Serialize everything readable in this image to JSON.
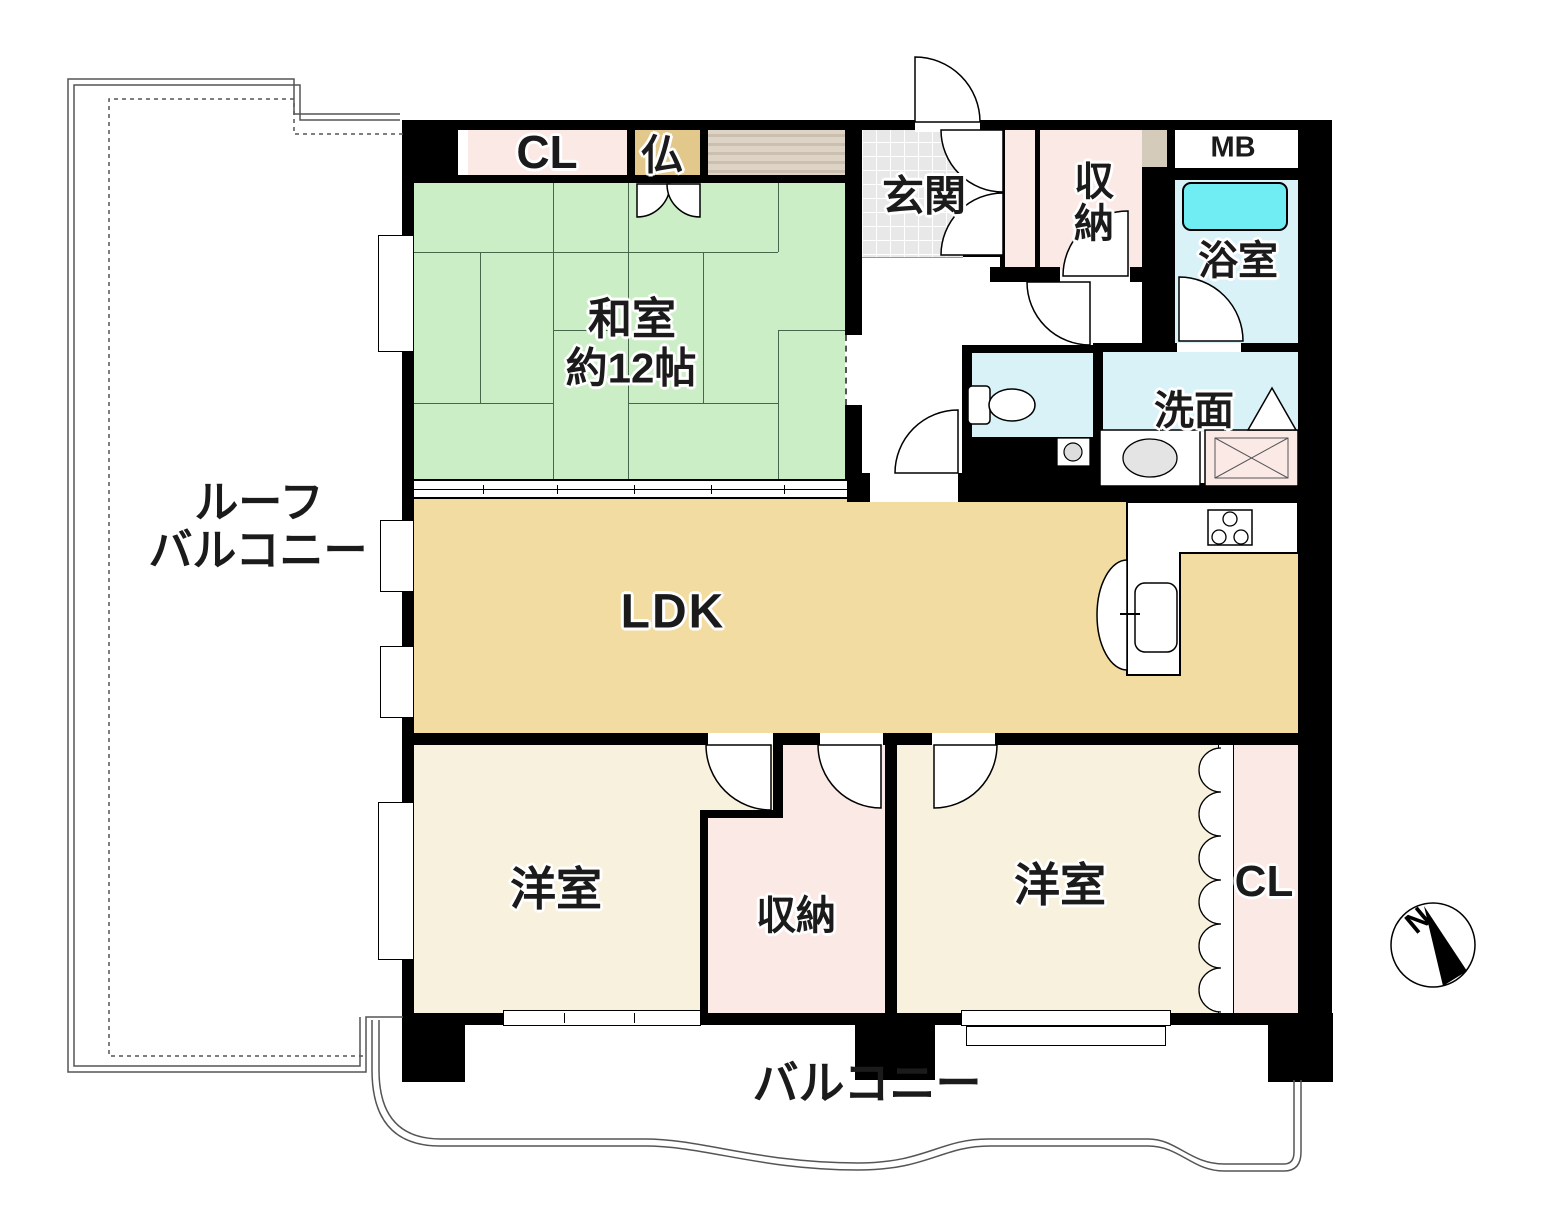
{
  "plan_title": "マンション間取り図",
  "rooms": {
    "roof_balcony": {
      "line1": "ルーフ",
      "line2": "バルコニー"
    },
    "washitsu": {
      "name": "和室",
      "size": "約12帖"
    },
    "closet_top": {
      "label": "CL"
    },
    "butsudan": {
      "label": "仏"
    },
    "genkan": {
      "label": "玄関"
    },
    "storage_top": {
      "label": "収納"
    },
    "meter_box": {
      "label": "MB"
    },
    "bathroom": {
      "label": "浴室"
    },
    "washroom": {
      "label": "洗面"
    },
    "ldk": {
      "label": "LDK"
    },
    "bedroom_left": {
      "label": "洋室"
    },
    "storage_bottom": {
      "label": "収納"
    },
    "bedroom_right": {
      "label": "洋室"
    },
    "closet_bottom": {
      "label": "CL"
    },
    "balcony": {
      "label": "バルコニー"
    },
    "compass": {
      "north": "N"
    }
  },
  "colors": {
    "wall": "#000000",
    "tatami": "#cbeec6",
    "ldk": "#f2dca2",
    "bedroom": "#f8f1de",
    "closet_pink": "#fbe9e6",
    "butsudan_tan": "#e2c98b",
    "tile_gray": "#e8e8e8",
    "bath_floor": "#d9f2f8",
    "tub_cyan": "#70edf3",
    "shelf_tan": "#d5cbbb",
    "line_green": "#47664a"
  }
}
